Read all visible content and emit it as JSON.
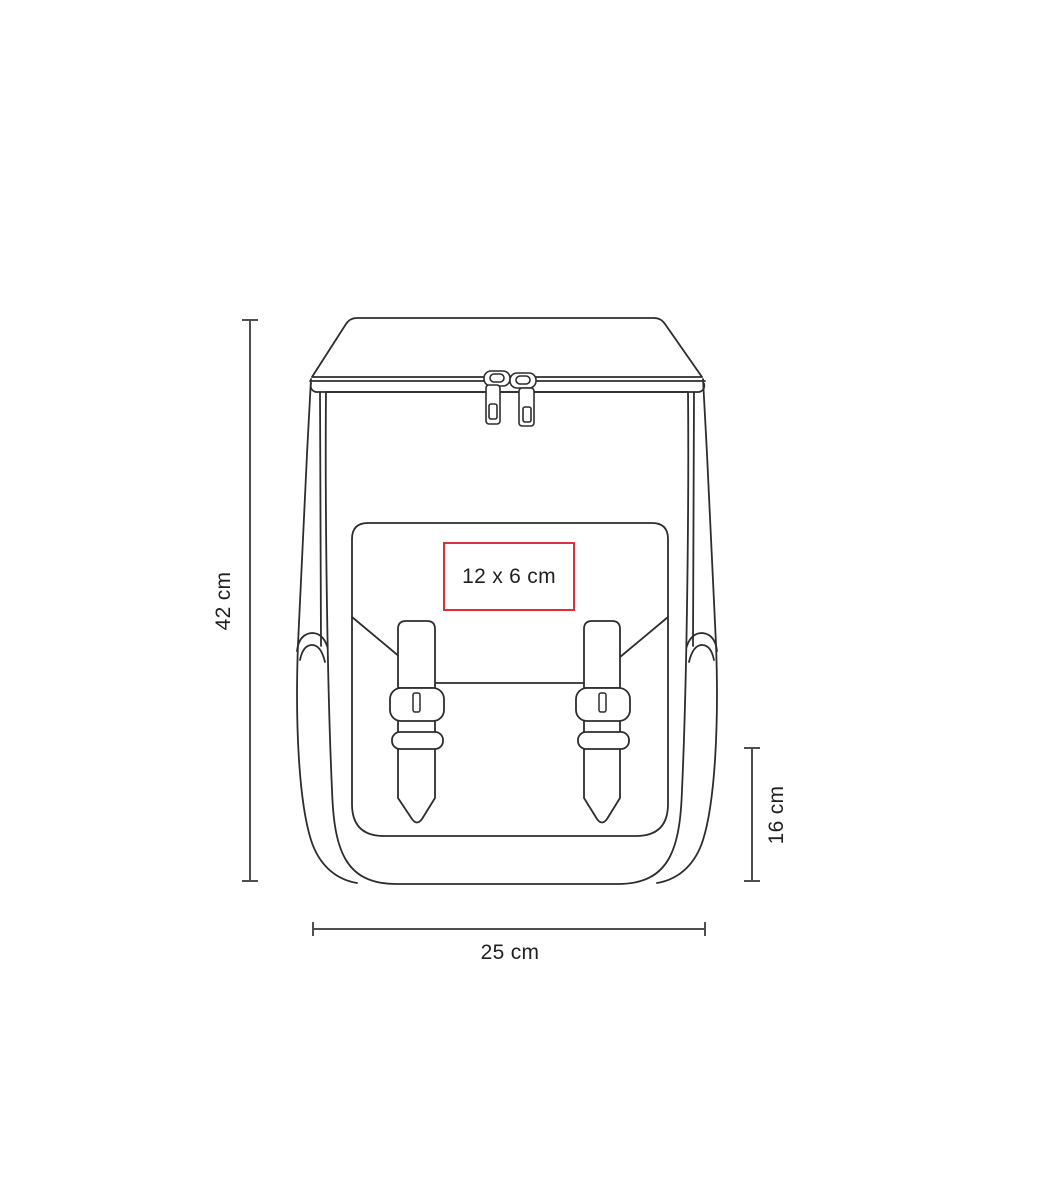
{
  "page": {
    "background_color": "#ffffff"
  },
  "diagram": {
    "type": "product-dimension-diagram",
    "subject": "backpack front-view line drawing",
    "line_color": "#2f2c2d",
    "dimension_line_color": "#4f4f51",
    "text_color": "#231f20",
    "dimensions": {
      "height_label": "42 cm",
      "width_label": "25 cm",
      "front_pocket_height_label": "16 cm"
    },
    "imprint_area": {
      "label": "12 x 6 cm",
      "border_color": "#e02f35"
    }
  }
}
